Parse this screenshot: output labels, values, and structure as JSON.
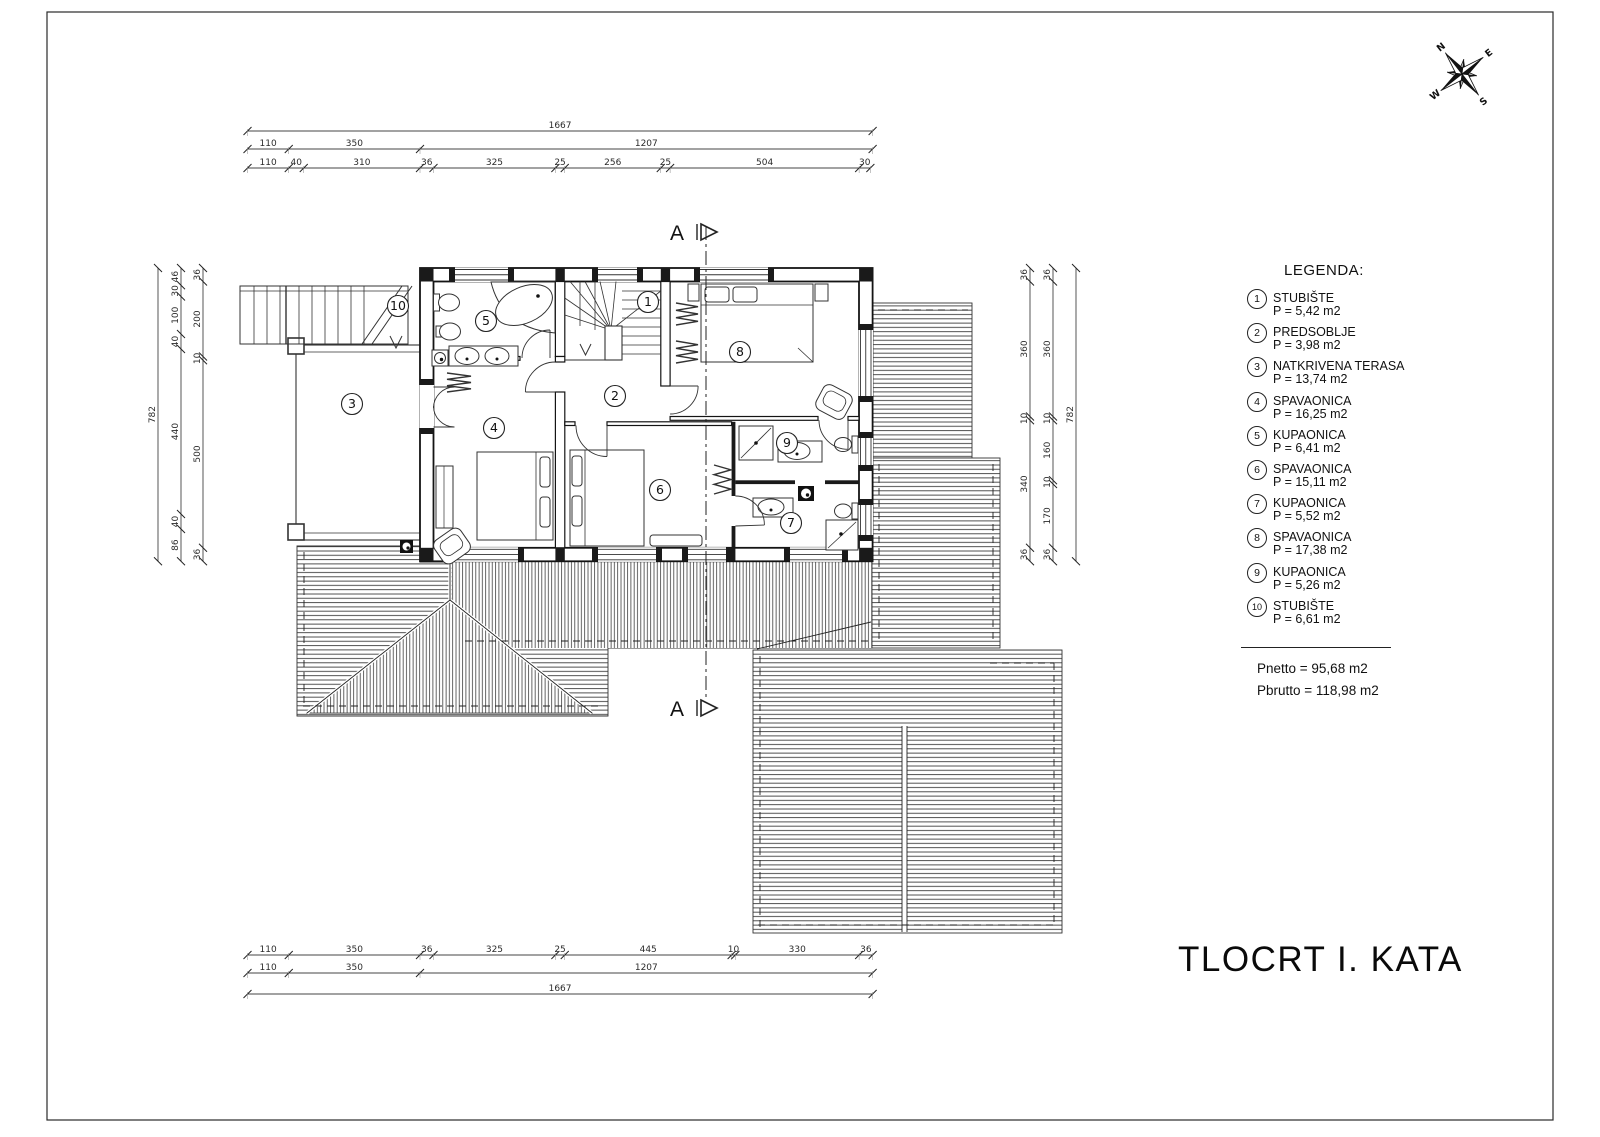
{
  "title": "TLOCRT I. KATA",
  "legend": {
    "title": "LEGENDA:",
    "items": [
      {
        "num": "1",
        "name": "STUBIŠTE",
        "area": "P = 5,42 m2"
      },
      {
        "num": "2",
        "name": "PREDSOBLJE",
        "area": "P = 3,98 m2"
      },
      {
        "num": "3",
        "name": "NATKRIVENA TERASA",
        "area": "P = 13,74 m2"
      },
      {
        "num": "4",
        "name": "SPAVAONICA",
        "area": "P = 16,25 m2"
      },
      {
        "num": "5",
        "name": "KUPAONICA",
        "area": "P = 6,41 m2"
      },
      {
        "num": "6",
        "name": "SPAVAONICA",
        "area": "P = 15,11 m2"
      },
      {
        "num": "7",
        "name": "KUPAONICA",
        "area": "P = 5,52 m2"
      },
      {
        "num": "8",
        "name": "SPAVAONICA",
        "area": "P = 17,38 m2"
      },
      {
        "num": "9",
        "name": "KUPAONICA",
        "area": "P = 5,26 m2"
      },
      {
        "num": "10",
        "name": "STUBIŠTE",
        "area": "P = 6,61 m2"
      }
    ],
    "totals": [
      "Pnetto = 95,68 m2",
      "Pbrutto = 118,98 m2"
    ]
  },
  "section_marker": {
    "label": "A"
  },
  "compass": {
    "n": "N",
    "e": "E",
    "s": "S",
    "w": "W"
  },
  "dimensions": {
    "top": [
      [
        "1667"
      ],
      [
        "110",
        "350",
        "1207"
      ],
      [
        "110",
        "40",
        "310",
        "36",
        "325",
        "25",
        "256",
        "25",
        "504",
        "30"
      ]
    ],
    "bottom": [
      [
        "110",
        "350",
        "36",
        "325",
        "25",
        "445",
        "10",
        "330",
        "36"
      ],
      [
        "110",
        "350",
        "1207"
      ],
      [
        "1667"
      ]
    ],
    "left": [
      [
        "782"
      ],
      [
        "46",
        "30",
        "100",
        "40",
        "440",
        "40",
        "86"
      ],
      [
        "36",
        "200",
        "10",
        "500",
        "36"
      ]
    ],
    "right": [
      [
        "36",
        "360",
        "10",
        "340",
        "36"
      ],
      [
        "36",
        "360",
        "10",
        "160",
        "10",
        "170",
        "36"
      ],
      [
        "782"
      ]
    ]
  },
  "rooms": [
    "1",
    "2",
    "3",
    "4",
    "5",
    "6",
    "7",
    "8",
    "9",
    "10"
  ]
}
